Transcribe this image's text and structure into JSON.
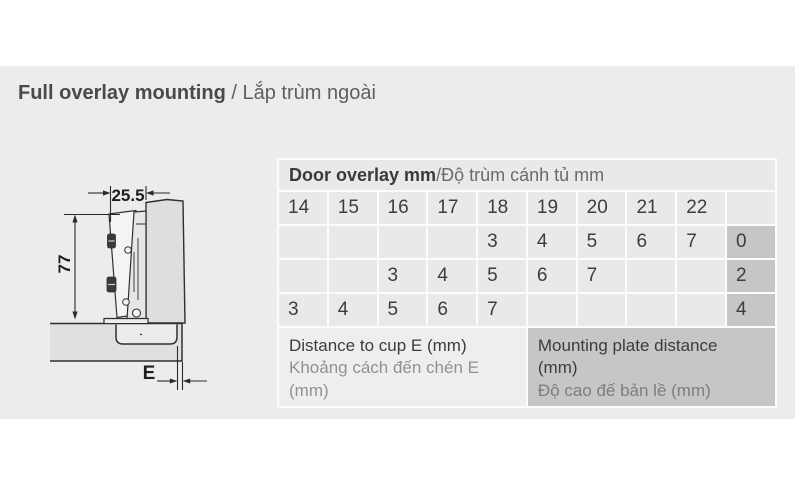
{
  "title": {
    "en": "Full overlay mounting",
    "sep": " / ",
    "vi": "Lắp trùm ngoài"
  },
  "table": {
    "header": {
      "en": "Door overlay mm",
      "sep": " / ",
      "vi": "Độ trùm cánh tủ mm"
    },
    "overlay_values": [
      "14",
      "15",
      "16",
      "17",
      "18",
      "19",
      "20",
      "21",
      "22"
    ],
    "rows": [
      {
        "cells": [
          "",
          "",
          "",
          "",
          "3",
          "4",
          "5",
          "6",
          "7"
        ],
        "plate": "0"
      },
      {
        "cells": [
          "",
          "",
          "3",
          "4",
          "5",
          "6",
          "7",
          "",
          ""
        ],
        "plate": "2"
      },
      {
        "cells": [
          "3",
          "4",
          "5",
          "6",
          "7",
          "",
          "",
          "",
          ""
        ],
        "plate": "4"
      }
    ],
    "footer": {
      "left": {
        "en": "Distance to cup E (mm)",
        "vi": "Khoảng cách đến chén E (mm)"
      },
      "right": {
        "en": "Mounting plate distance (mm)",
        "vi": "Độ cao đế bản lề (mm)"
      }
    }
  },
  "diagram": {
    "top_width": "25.5",
    "height": "77",
    "cup_distance": "E"
  },
  "colors": {
    "page_band": "#ececec",
    "table_cell": "#e9e9e9",
    "highlight_cell": "#c6c6c6",
    "gridline": "#fcfcfc"
  }
}
